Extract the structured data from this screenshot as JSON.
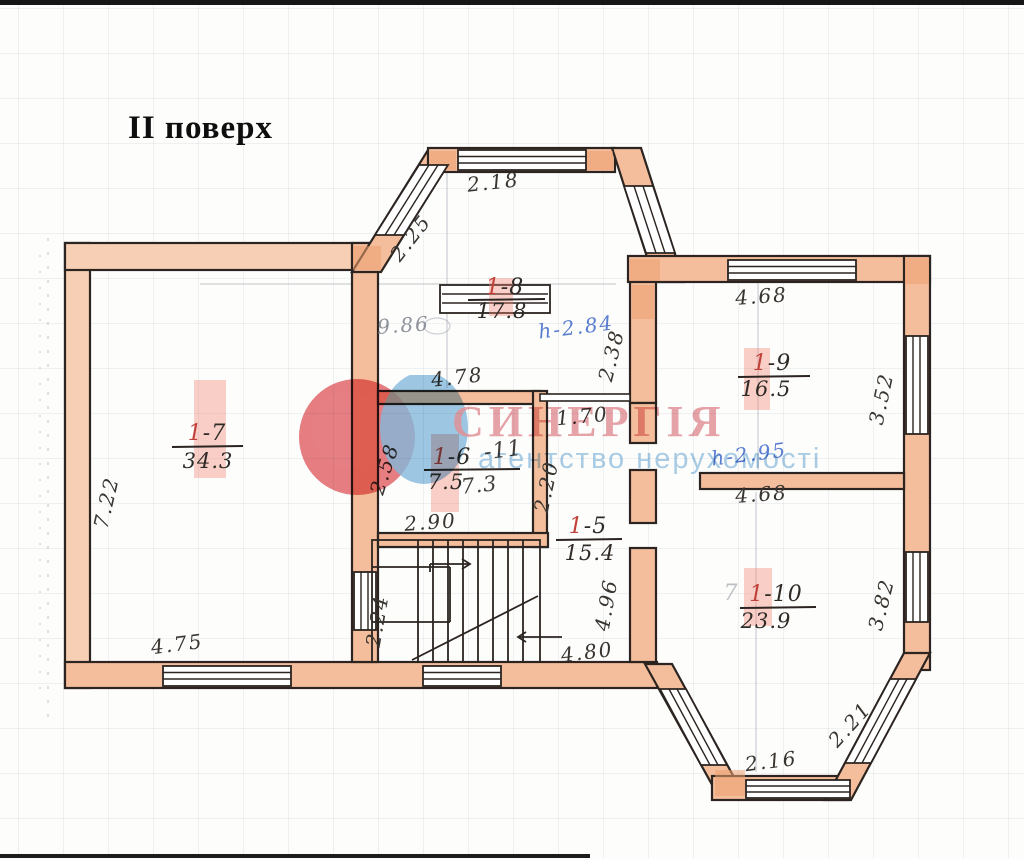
{
  "title": "II поверх",
  "watermark": {
    "brand": "СИНЕРГІЯ",
    "tagline": "агентство нерухомості"
  },
  "rooms": {
    "r7": {
      "prefix": "1",
      "suffix": "-7",
      "area": "34.3"
    },
    "r8": {
      "prefix": "1",
      "suffix": "-8",
      "area": "17.8"
    },
    "r6": {
      "prefix": "1",
      "suffix": "-6",
      "area": "7.5",
      "overlay_suffix": "-11",
      "overlay_area": "7.3"
    },
    "r5": {
      "prefix": "1",
      "suffix": "-5",
      "area": "15.4"
    },
    "r9": {
      "prefix": "1",
      "suffix": "-9",
      "area": "16.5"
    },
    "r10": {
      "prefix": "1",
      "suffix": "-10",
      "area": "23.9",
      "pencil_ghost": "7"
    }
  },
  "dims": {
    "bay_top": "2.18",
    "bay_left": "2.25",
    "hall_width": "9.86",
    "hall_height": "h-2.84",
    "hall_right": "2.38",
    "hall_bottom": "4.78",
    "r9_top": "4.68",
    "r9_right": "3.52",
    "left_wall": "7.22",
    "r6_left": "2.58",
    "r6_width": "2.90",
    "corridor_top": "1.70",
    "corridor_len": "2.20",
    "stair_right": "4.96",
    "stair_left": "2.24",
    "r10_top": "4.68",
    "r10_height": "h-2.95",
    "r10_right": "3.82",
    "bottom_left": "4.75",
    "bottom_center": "4.80",
    "bay2_bottom": "2.16",
    "bay2_right": "2.21"
  },
  "colors": {
    "wall_fill": "#f4bd9c",
    "ink_line": "#2b2420",
    "dim_ink": "#38342f",
    "red_ink": "#c2403a",
    "blue_ink": "#5b7ed0",
    "pencil": "#8e929b",
    "brand_pink": "#e28f96",
    "tagline_blue": "#a7cce6",
    "highlight_band": "#ef8070"
  }
}
